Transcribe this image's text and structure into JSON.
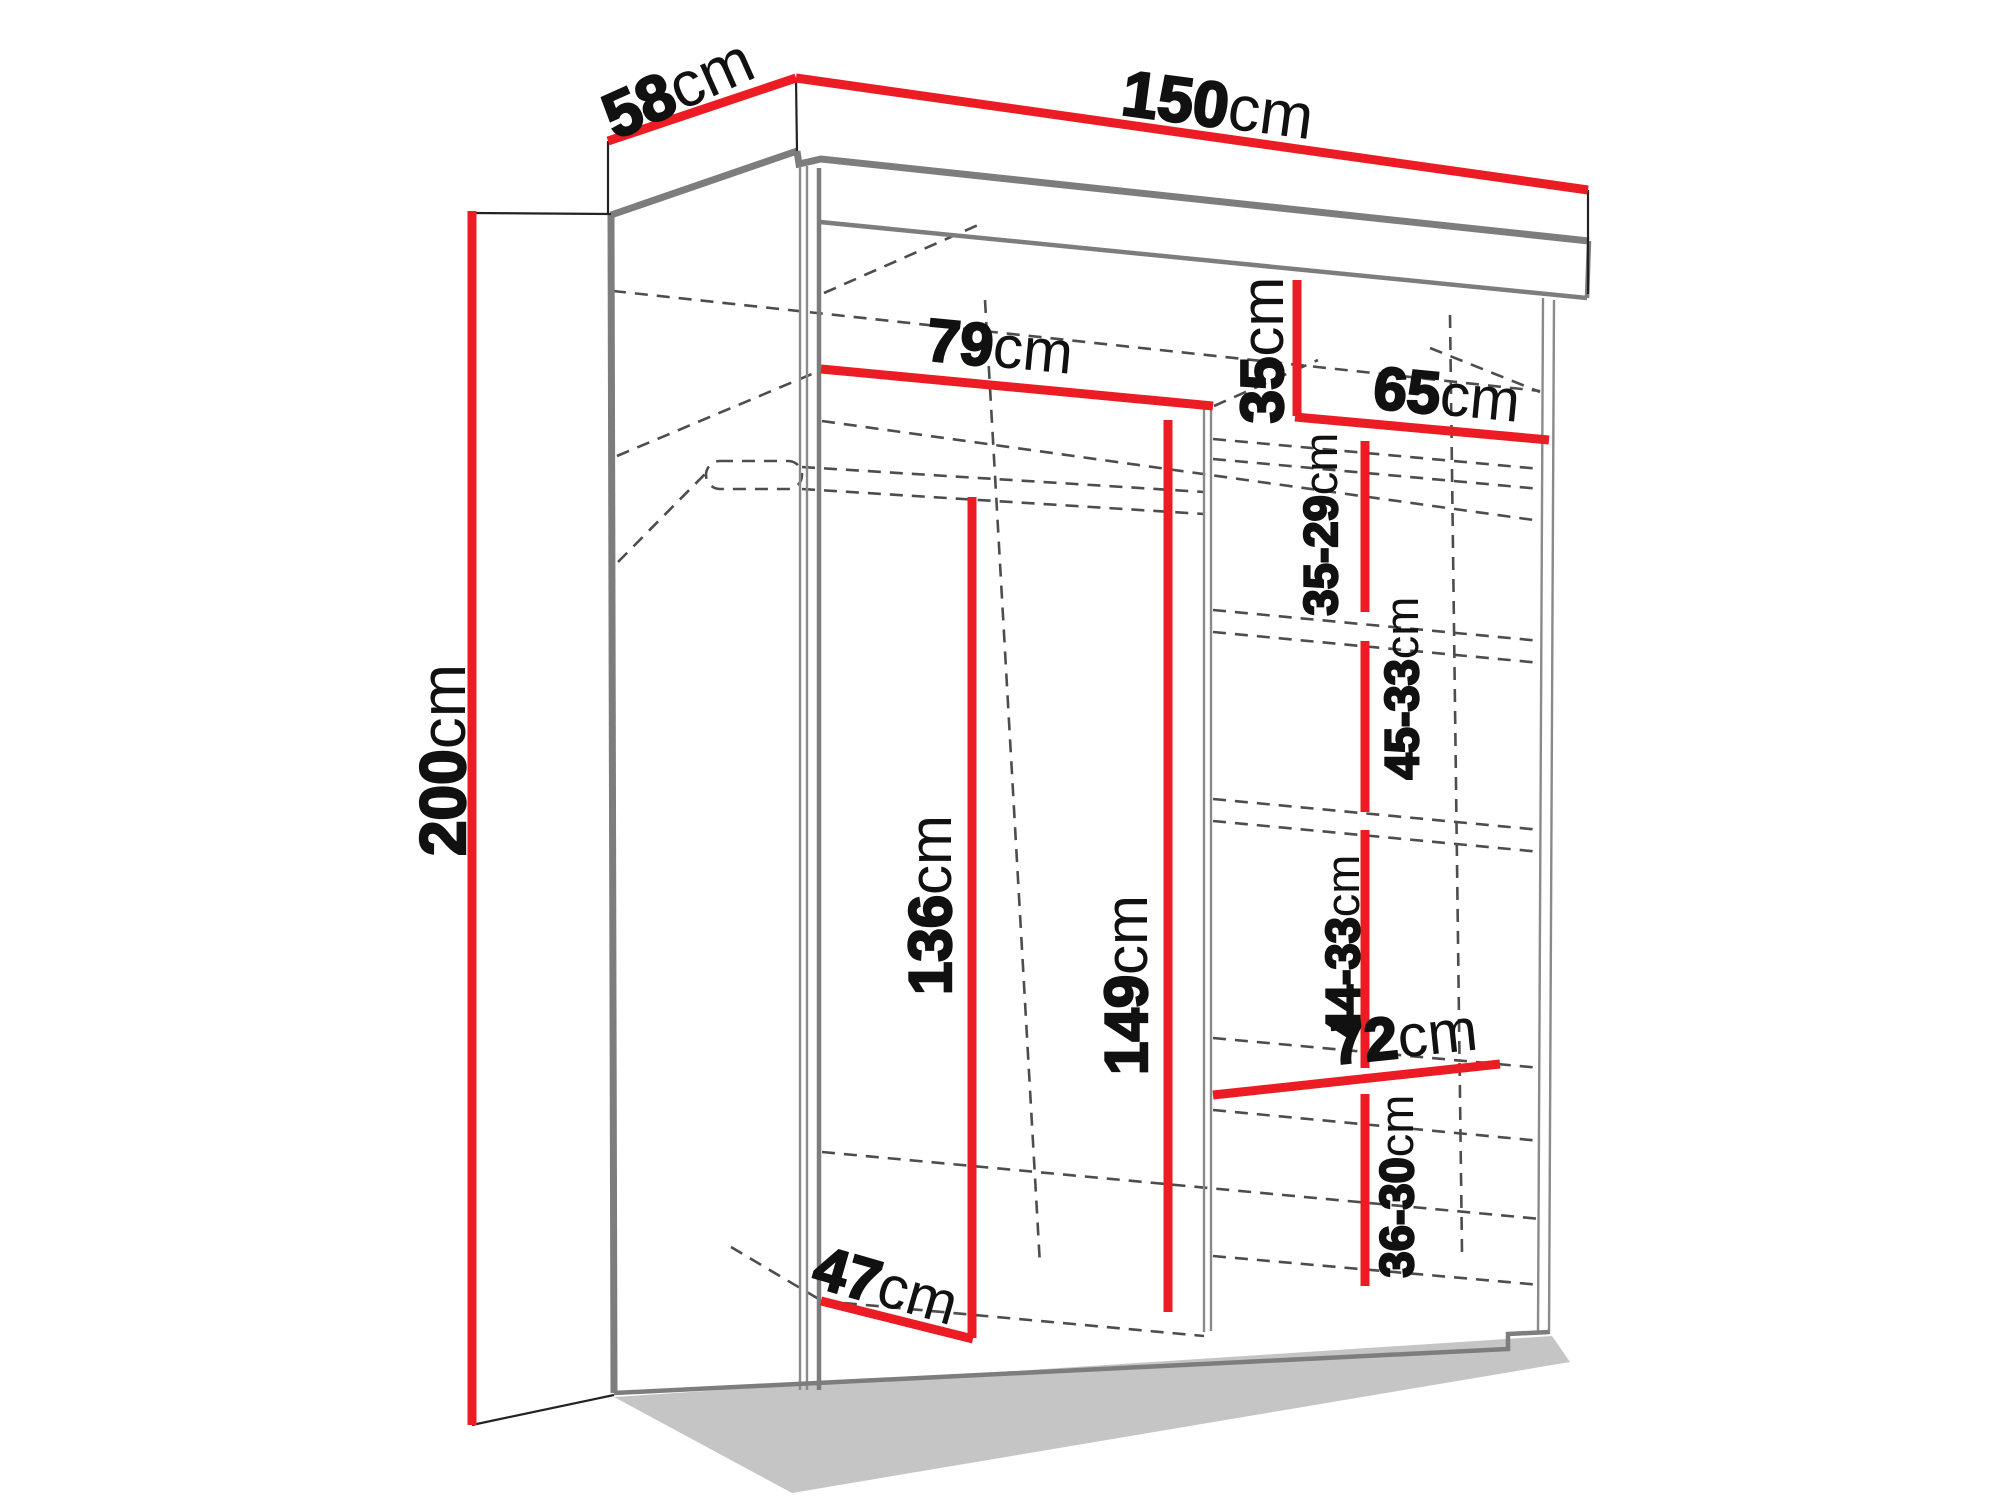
{
  "drawing": {
    "unit": "cm",
    "colors": {
      "dimension_line": "#ec1c24",
      "structure": "#7d7d7d",
      "hidden_line": "#4d4d4d",
      "text": "#111111",
      "background": "#ffffff"
    }
  },
  "dims": {
    "depth": {
      "value": "58",
      "unit": "cm"
    },
    "width": {
      "value": "150",
      "unit": "cm"
    },
    "height": {
      "value": "200",
      "unit": "cm"
    },
    "left_width": {
      "value": "79",
      "unit": "cm"
    },
    "top_shelf": {
      "value": "35",
      "unit": "cm"
    },
    "right_width": {
      "value": "65",
      "unit": "cm"
    },
    "gap1": {
      "value": "35-29",
      "unit": "cm"
    },
    "gap2": {
      "value": "45-33",
      "unit": "cm"
    },
    "gap3": {
      "value": "44-33",
      "unit": "cm"
    },
    "shelf72": {
      "value": "72",
      "unit": "cm"
    },
    "gap4": {
      "value": "36-30",
      "unit": "cm"
    },
    "hang136": {
      "value": "136",
      "unit": "cm"
    },
    "div149": {
      "value": "149",
      "unit": "cm"
    },
    "depth47": {
      "value": "47",
      "unit": "cm"
    }
  }
}
